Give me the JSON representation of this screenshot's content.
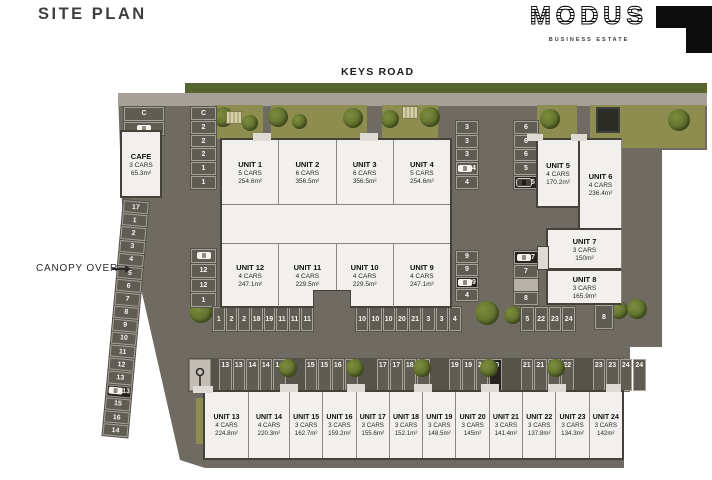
{
  "page": {
    "title": "SITE PLAN"
  },
  "logo": {
    "name": "MODUS",
    "tagline": "BUSINESS ESTATE"
  },
  "plan": {
    "road_label": "KEYS ROAD",
    "canopy_label": "CANOPY OVER"
  },
  "cafe": {
    "name": "CAFE",
    "cars": "3 CARS",
    "area": "65.3m²"
  },
  "units": [
    {
      "name": "UNIT 1",
      "cars": "5 CARS",
      "area": "254.6m²"
    },
    {
      "name": "UNIT 2",
      "cars": "6 CARS",
      "area": "356.5m²"
    },
    {
      "name": "UNIT 3",
      "cars": "6 CARS",
      "area": "356.5m²"
    },
    {
      "name": "UNIT 4",
      "cars": "5 CARS",
      "area": "254.6m²"
    },
    {
      "name": "UNIT 5",
      "cars": "4 CARS",
      "area": "170.2m²"
    },
    {
      "name": "UNIT 6",
      "cars": "4 CARS",
      "area": "236.4m²"
    },
    {
      "name": "UNIT 7",
      "cars": "3 CARS",
      "area": "150m²"
    },
    {
      "name": "UNIT 8",
      "cars": "3 CARS",
      "area": "165.9m²"
    },
    {
      "name": "UNIT 9",
      "cars": "4 CARS",
      "area": "247.1m²"
    },
    {
      "name": "UNIT 10",
      "cars": "4 CARS",
      "area": "229.5m²"
    },
    {
      "name": "UNIT 11",
      "cars": "4 CARS",
      "area": "229.5m²"
    },
    {
      "name": "UNIT 12",
      "cars": "4 CARS",
      "area": "247.1m²"
    },
    {
      "name": "UNIT 13",
      "cars": "4 CARS",
      "area": "224.8m²"
    },
    {
      "name": "UNIT 14",
      "cars": "4 CARS",
      "area": "220.3m²"
    },
    {
      "name": "UNIT 15",
      "cars": "3 CARS",
      "area": "162.7m²"
    },
    {
      "name": "UNIT 16",
      "cars": "3 CARS",
      "area": "159.2m²"
    },
    {
      "name": "UNIT 17",
      "cars": "3 CARS",
      "area": "155.6m²"
    },
    {
      "name": "UNIT 18",
      "cars": "3 CARS",
      "area": "152.1m²"
    },
    {
      "name": "UNIT 19",
      "cars": "3 CARS",
      "area": "148.5m²"
    },
    {
      "name": "UNIT 20",
      "cars": "3 CARS",
      "area": "145m²"
    },
    {
      "name": "UNIT 21",
      "cars": "3 CARS",
      "area": "141.4m²"
    },
    {
      "name": "UNIT 22",
      "cars": "3 CARS",
      "area": "137.8m²"
    },
    {
      "name": "UNIT 23",
      "cars": "3 CARS",
      "area": "134.3m²"
    },
    {
      "name": "UNIT 24",
      "cars": "3 CARS",
      "area": "142m²"
    }
  ],
  "parking": {
    "cafe_spots": [
      "C",
      "C"
    ],
    "north_col": [
      "C",
      "2",
      "2",
      "2",
      "1",
      "1"
    ],
    "canopy_lane": [
      "17",
      "1",
      "2",
      "3",
      "4",
      "5",
      "6",
      "7",
      "8",
      "9",
      "10",
      "11",
      "12",
      "13",
      "13",
      "15",
      "16",
      "14"
    ],
    "unit12_col": [
      "12",
      "12",
      "1"
    ],
    "n_left": [
      "3",
      "3",
      "3",
      "4",
      "4"
    ],
    "n_right": [
      "6",
      "6",
      "6",
      "5",
      "5"
    ],
    "s_left": [
      "9",
      "9",
      "9",
      "4"
    ],
    "s_right": [
      "7",
      "7",
      "8"
    ],
    "mid_left": [
      "1",
      "2",
      "2",
      "18",
      "19",
      "11",
      "11",
      "11"
    ],
    "mid_right": [
      "10",
      "10",
      "10",
      "20",
      "21",
      "3",
      "3",
      "4"
    ],
    "east_row": [
      "5",
      "22",
      "23",
      "24"
    ],
    "east_single": "8",
    "south_row": [
      "13",
      "13",
      "14",
      "14",
      "14",
      "15",
      "15",
      "16",
      "16",
      "17",
      "17",
      "18",
      "18",
      "19",
      "19",
      "20",
      "20",
      "21",
      "21",
      "22",
      "22",
      "23",
      "23",
      "24",
      "24"
    ]
  },
  "colors": {
    "asphalt": "#6f6b62",
    "apron": "#56534b",
    "spot": "#5f5c54",
    "spot_dark": "#26241f",
    "unit_fill": "#f1f0ed",
    "grass": "#8e8d50",
    "tree": "#6c7a33",
    "road": "#a5a198",
    "green_strip": "#56652e",
    "logo_black": "#0d0d0d"
  }
}
